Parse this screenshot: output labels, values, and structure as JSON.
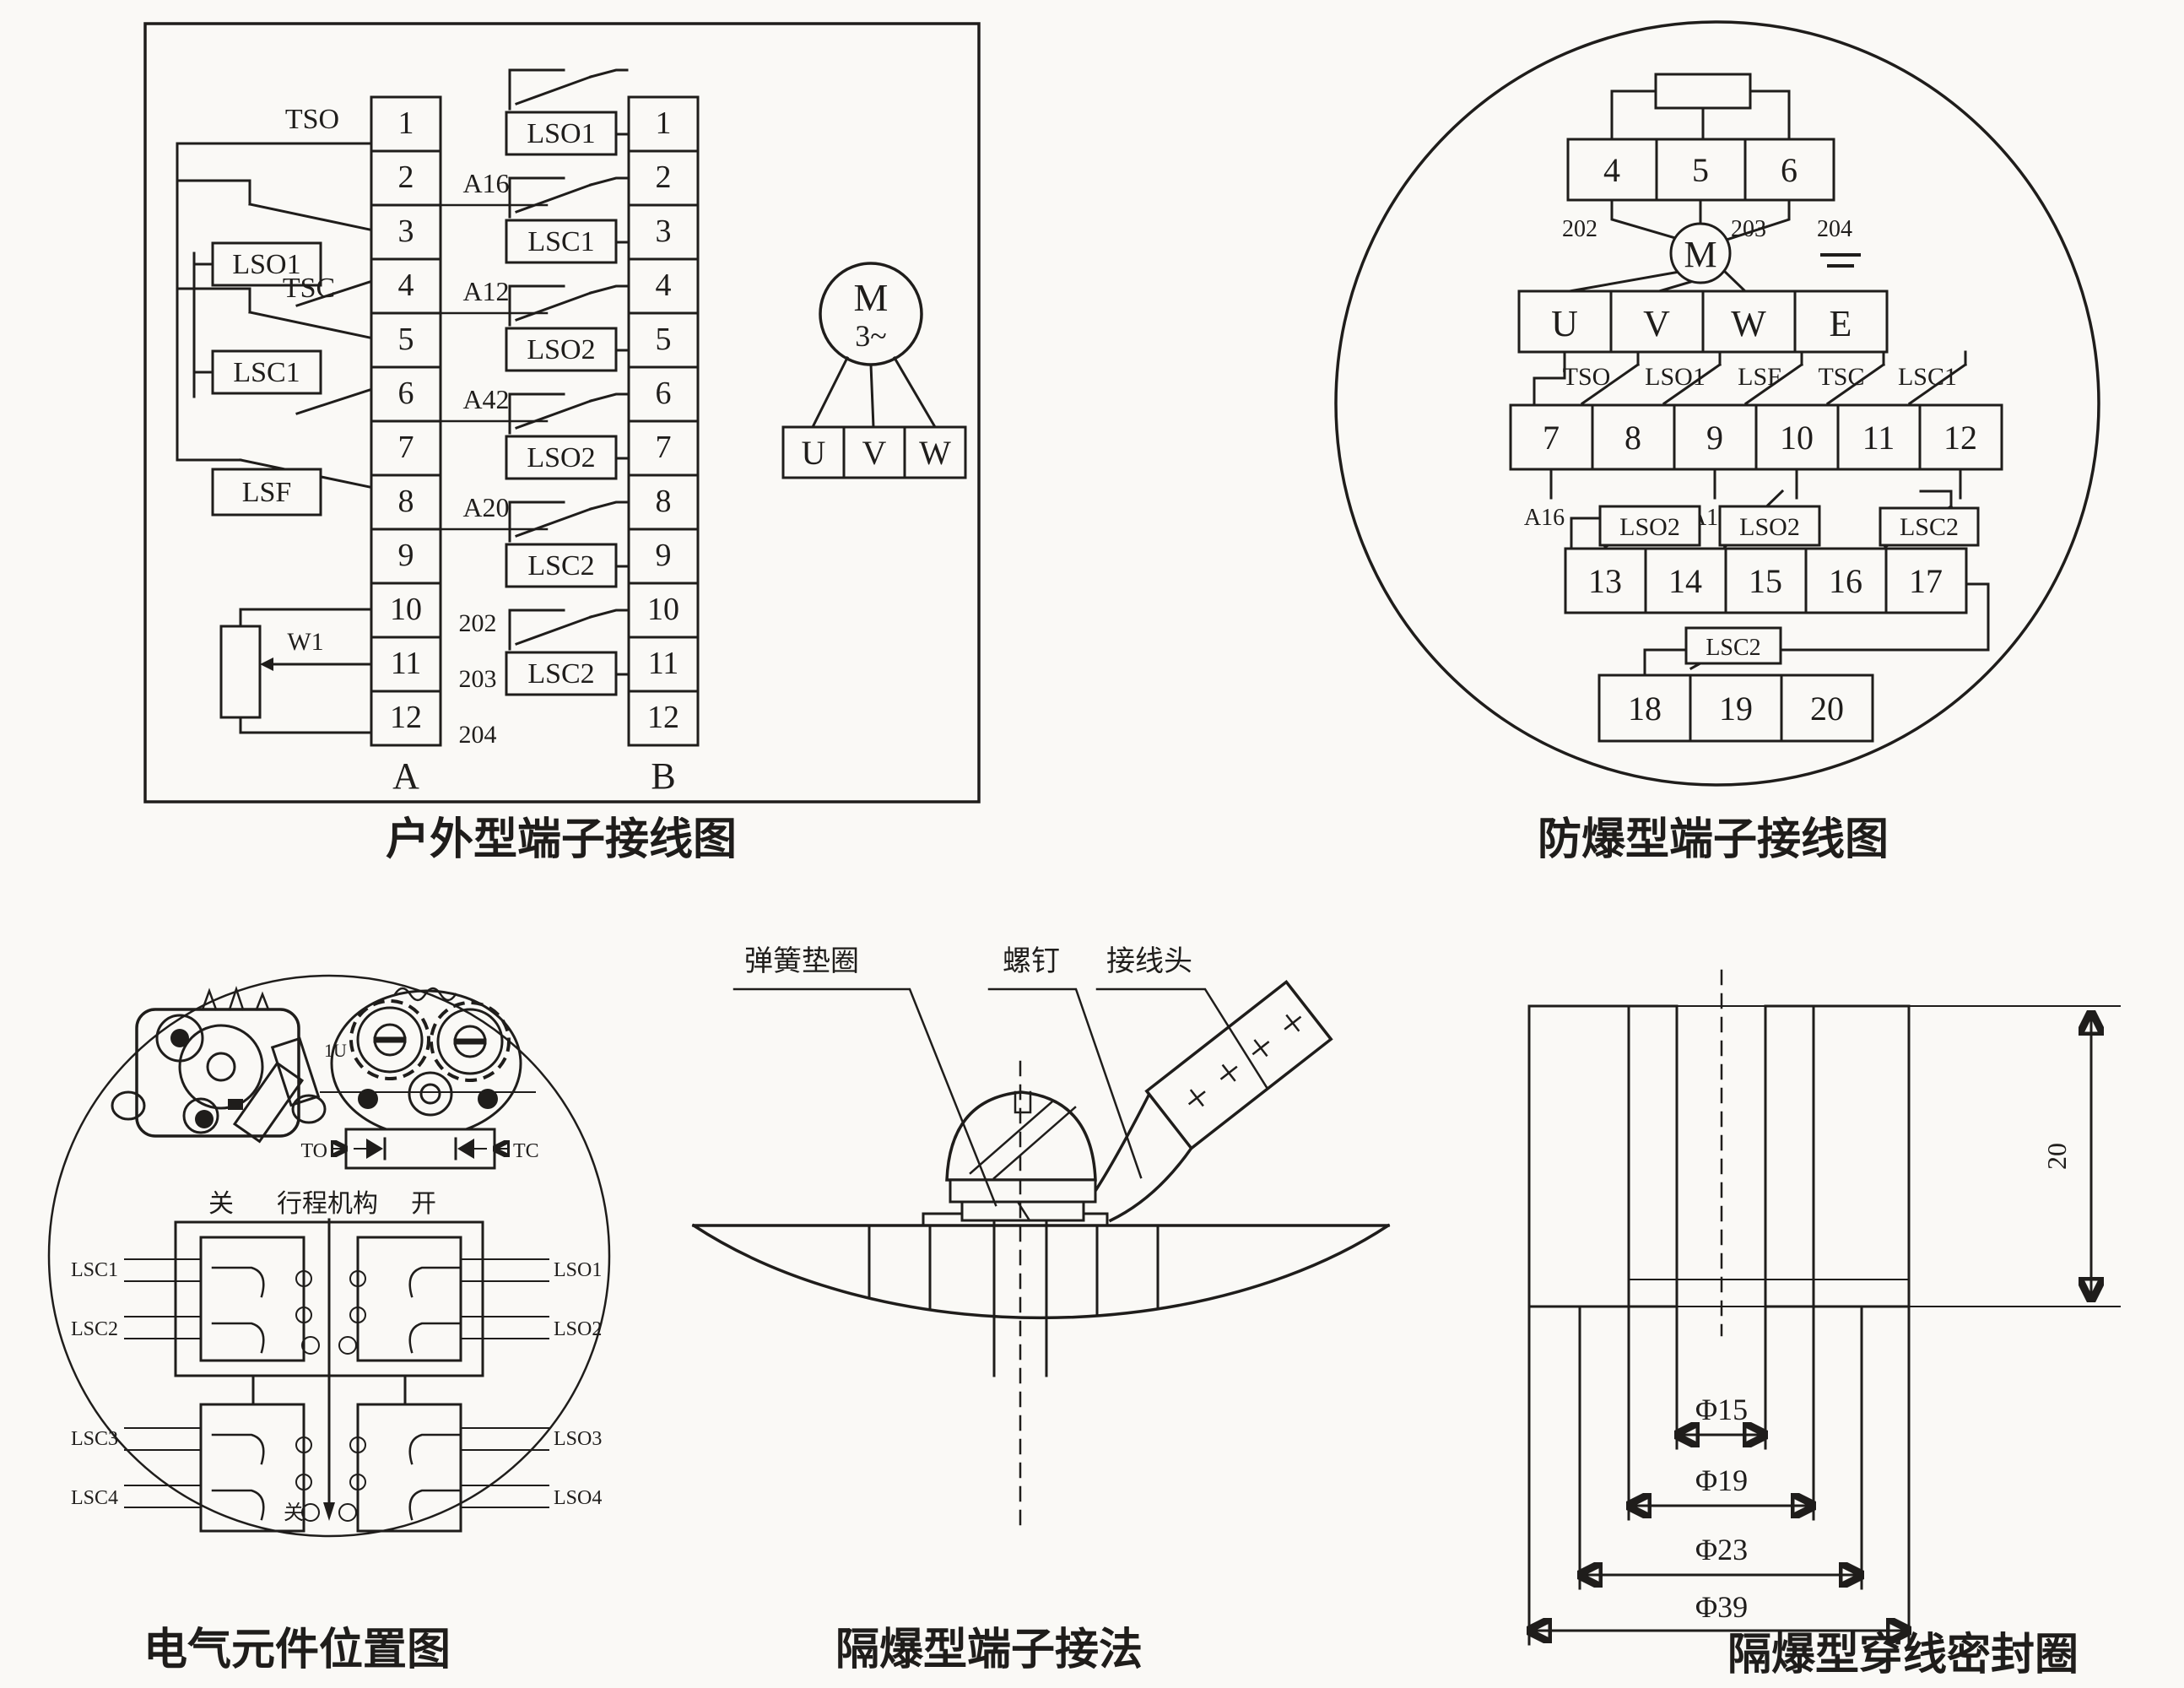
{
  "outdoor": {
    "caption": "户外型端子接线图",
    "strip_a": {
      "label": "A",
      "terminals": [
        "1",
        "2",
        "3",
        "4",
        "5",
        "6",
        "7",
        "8",
        "9",
        "10",
        "11",
        "12"
      ],
      "sw_tso": "TSO",
      "sw_lso1": "LSO1",
      "sw_tsc": "TSC",
      "sw_lsc1": "LSC1",
      "sw_lsf": "LSF",
      "pot": "W1",
      "w_a16": "A16",
      "w_a12": "A12",
      "w_a42": "A42",
      "w_a20": "A20",
      "w_202": "202",
      "w_203": "203",
      "w_204": "204"
    },
    "strip_b": {
      "label": "B",
      "terminals": [
        "1",
        "2",
        "3",
        "4",
        "5",
        "6",
        "7",
        "8",
        "9",
        "10",
        "11",
        "12"
      ],
      "switches": [
        "LSO1",
        "LSC1",
        "LSO2",
        "LSO2",
        "LSC2",
        "LSC2"
      ]
    },
    "motor": {
      "symbol": "M",
      "phase": "3~",
      "terminals": [
        "U",
        "V",
        "W"
      ]
    }
  },
  "explosion": {
    "caption": "防爆型端子接线图",
    "row1": [
      "4",
      "5",
      "6"
    ],
    "row1_wires": [
      "202",
      "203",
      "204"
    ],
    "motor": "M",
    "row2": [
      "U",
      "V",
      "W",
      "E"
    ],
    "row2_switches": [
      "TSO",
      "LSO1",
      "LSF",
      "TSC",
      "LSC1"
    ],
    "row3": [
      "7",
      "8",
      "9",
      "10",
      "11",
      "12"
    ],
    "row3_wires": [
      "A16",
      "A12",
      "A20",
      "A42"
    ],
    "row4_switches": [
      "LSO2",
      "LSO2",
      "LSC2"
    ],
    "row4": [
      "13",
      "14",
      "15",
      "16",
      "17"
    ],
    "row5_switch": "LSC2",
    "row5": [
      "18",
      "19",
      "20"
    ]
  },
  "components": {
    "caption": "电气元件位置图",
    "cam_label": "1U",
    "diode_left": "TO",
    "diode_right": "TC",
    "axis_left": "关",
    "axis_center": "行程机构",
    "axis_right": "开",
    "upper_left": [
      "LSC1",
      "LSC2"
    ],
    "upper_right": [
      "LSO1",
      "LSO2"
    ],
    "lower_left": [
      "LSC3",
      "LSC4"
    ],
    "lower_right": [
      "LSO3",
      "LSO4"
    ],
    "shaft_label": "关"
  },
  "connection": {
    "caption": "隔爆型端子接法",
    "label_washer": "弹簧垫圈",
    "label_screw": "螺钉",
    "label_lug": "接线头"
  },
  "seal": {
    "caption": "隔爆型穿线密封圈",
    "dim_height": "20",
    "dims": [
      "Φ15",
      "Φ19",
      "Φ23",
      "Φ39"
    ]
  }
}
